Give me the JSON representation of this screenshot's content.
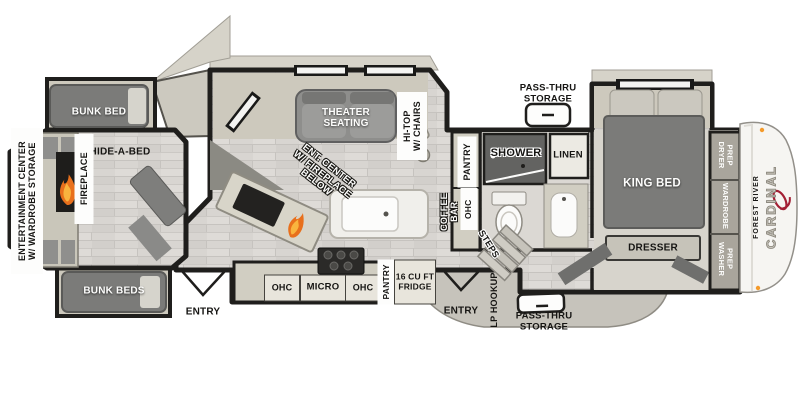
{
  "plan_type": "travel-trailer floor plan",
  "rear": {
    "entertainment_center": "ENTERTAINMENT CENTER\nW/ WARDROBE STORAGE",
    "bunk_bed": "BUNK BED",
    "hide_a_bed": "HIDE-A-BED",
    "fireplace": "FIREPLACE",
    "bunk_beds": "BUNK BEDS",
    "entry": "ENTRY"
  },
  "living": {
    "theater_seating": "THEATER\nSEATING",
    "hi_top": "HI-TOP\nW/ CHAIRS",
    "ent_center": "ENT. CENTER\nW/ FIREPLACE\nBELOW"
  },
  "kitchen": {
    "ohc_left": "OHC",
    "micro": "MICRO",
    "ohc_right": "OHC",
    "pantry": "PANTRY",
    "fridge": "16 CU FT\nFRIDGE",
    "coffee_bar": "COFFEE\nBAR",
    "ohc_upper": "OHC",
    "pantry_upper": "PANTRY"
  },
  "bath": {
    "shower": "SHOWER",
    "linen": "LINEN"
  },
  "storage": {
    "pass_thru_top": "PASS-THRU\nSTORAGE",
    "pass_thru_bottom": "PASS-THRU\nSTORAGE",
    "lp_hookup": "LP HOOKUP"
  },
  "circulation": {
    "steps": "STEPS",
    "entry": "ENTRY"
  },
  "bedroom": {
    "king_bed": "KING BED",
    "dresser": "DRESSER",
    "dryer_prep": "DRYER\nPREP",
    "wardrobe": "WARDROBE",
    "washer_prep": "WASHER\nPREP"
  },
  "brand": {
    "manufacturer": "FOREST RIVER",
    "model": "CARDINAL"
  },
  "colors": {
    "wall": "#1f1e1c",
    "cabinet": "#d1cec2",
    "floor": "#d8d5d1",
    "furniture": "#7b7b79",
    "slide_floor": "#cdc9bd",
    "flame": "#e8701c",
    "logo_red": "#a32035"
  }
}
